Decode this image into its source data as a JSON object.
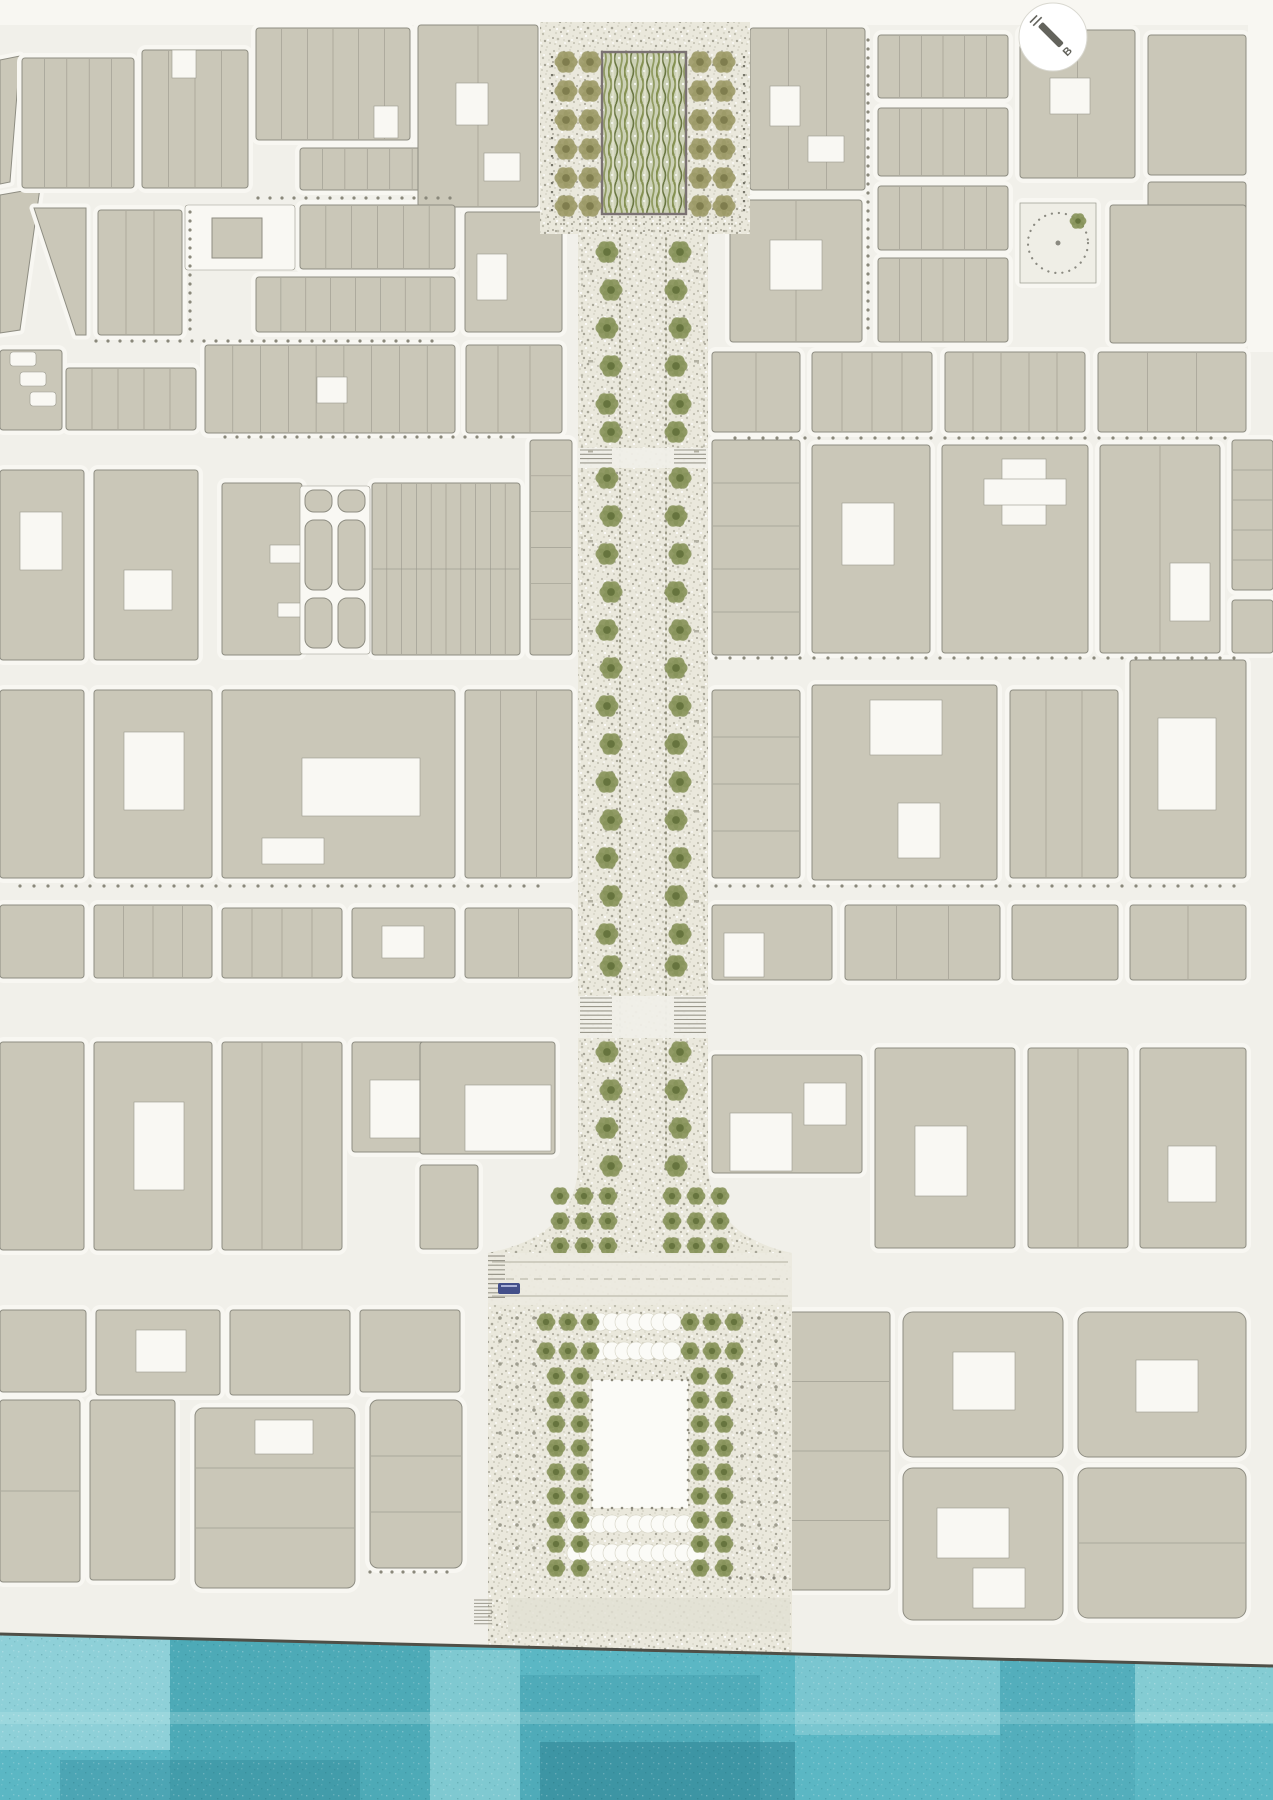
{
  "meta": {
    "width": 1273,
    "height": 1800,
    "label": "urban-masterplan-site-plan"
  },
  "north_arrow": {
    "letter": "B"
  },
  "colors": {
    "street": "#f1f0ea",
    "sidewalk": "#f8f7f2",
    "building": "#cac7b8",
    "outline": "#8e8d82",
    "divline": "#9a988c",
    "plot": "#f9f8f3",
    "plotLine": "#99988d",
    "stipBase": "#eae8dc",
    "stipA": "#d8d6c8",
    "stipB": "#c0beaf",
    "stipC": "#a6a496",
    "oliveL": "#9aa668",
    "oliveM": "#87935a",
    "oliveD": "#66743e",
    "khakiL": "#b3af7e",
    "khakiM": "#9c9a67",
    "khakiD": "#7f7d4e",
    "gardenBase": "#ccd1b6",
    "gardenA": "#7d8b47",
    "gardenB": "#5f6e35",
    "gardenC": "#e4e6d2",
    "gardenBorder": "#7b7273",
    "dotline": "#85836f",
    "bollard": "#77766a",
    "gridDot": "#8b897b",
    "crossBand": "#f0efe8",
    "ladder": "#9a988c",
    "roadFill": "#eceadf",
    "roadMark": "#b2b0a1",
    "bus": "#44508a",
    "mall": "#fbfbf7",
    "scallop": "#fbfbf7",
    "scallopLine": "#d6d4c5",
    "quayStrip": "#e2e0d4",
    "waterBase": "#5bb7c4",
    "waterLight": "#c2eaec",
    "waterDark": "#3a95a5",
    "waterDeep": "#2b7f90",
    "waterLine": "#4f4f47",
    "needle": "#63635c",
    "circleRim": "#d9d8d0"
  },
  "bands": [
    [
      0,
      0,
      1273,
      25
    ],
    [
      1248,
      0,
      27,
      352
    ]
  ],
  "blocks": [
    {
      "x": 22,
      "y": 58,
      "w": 112,
      "h": 130,
      "v": 5
    },
    {
      "x": 142,
      "y": 50,
      "w": 106,
      "h": 138,
      "v": 4,
      "wh": [
        [
          30,
          0,
          24,
          28
        ]
      ]
    },
    {
      "x": 256,
      "y": 28,
      "w": 154,
      "h": 112,
      "v": 6,
      "wh": [
        [
          118,
          78,
          24,
          32
        ]
      ]
    },
    {
      "x": 300,
      "y": 148,
      "w": 157,
      "h": 42,
      "v": 7
    },
    {
      "x": 418,
      "y": 25,
      "w": 120,
      "h": 182,
      "v": 2,
      "wh": [
        [
          38,
          58,
          32,
          42
        ],
        [
          66,
          128,
          36,
          28
        ]
      ]
    },
    {
      "x": 98,
      "y": 210,
      "w": 84,
      "h": 125,
      "v": 3
    },
    {
      "x": 300,
      "y": 205,
      "w": 155,
      "h": 64,
      "v": 6
    },
    {
      "x": 256,
      "y": 277,
      "w": 199,
      "h": 55,
      "v": 8
    },
    {
      "x": 465,
      "y": 212,
      "w": 97,
      "h": 120,
      "wh": [
        [
          12,
          42,
          30,
          46
        ]
      ]
    },
    {
      "x": 0,
      "y": 350,
      "w": 62,
      "h": 80
    },
    {
      "x": 66,
      "y": 368,
      "w": 130,
      "h": 62,
      "v": 5
    },
    {
      "x": 205,
      "y": 345,
      "w": 250,
      "h": 88,
      "v": 9,
      "wh": [
        [
          112,
          32,
          30,
          26
        ]
      ]
    },
    {
      "x": 466,
      "y": 345,
      "w": 96,
      "h": 88,
      "v": 3
    },
    {
      "x": 0,
      "y": 470,
      "w": 84,
      "h": 190,
      "wh": [
        [
          20,
          42,
          42,
          58
        ]
      ]
    },
    {
      "x": 94,
      "y": 470,
      "w": 104,
      "h": 190,
      "wh": [
        [
          30,
          100,
          48,
          40
        ]
      ]
    },
    {
      "x": 222,
      "y": 483,
      "w": 80,
      "h": 172,
      "wh": [
        [
          48,
          62,
          32,
          18
        ],
        [
          56,
          120,
          24,
          14
        ]
      ]
    },
    {
      "x": 372,
      "y": 483,
      "w": 148,
      "h": 172,
      "v": 10,
      "hd": 2
    },
    {
      "x": 530,
      "y": 440,
      "w": 42,
      "h": 215,
      "hd": 6
    },
    {
      "x": 0,
      "y": 690,
      "w": 84,
      "h": 188
    },
    {
      "x": 94,
      "y": 690,
      "w": 118,
      "h": 188,
      "wh": [
        [
          30,
          42,
          60,
          78
        ]
      ]
    },
    {
      "x": 222,
      "y": 690,
      "w": 233,
      "h": 188,
      "wh": [
        [
          80,
          68,
          118,
          58
        ],
        [
          40,
          148,
          62,
          26
        ]
      ]
    },
    {
      "x": 465,
      "y": 690,
      "w": 107,
      "h": 188,
      "v": 3
    },
    {
      "x": 0,
      "y": 905,
      "w": 84,
      "h": 73
    },
    {
      "x": 94,
      "y": 905,
      "w": 118,
      "h": 73,
      "v": 4
    },
    {
      "x": 222,
      "y": 908,
      "w": 120,
      "h": 70,
      "v": 4
    },
    {
      "x": 352,
      "y": 908,
      "w": 103,
      "h": 70,
      "wh": [
        [
          30,
          18,
          42,
          32
        ]
      ]
    },
    {
      "x": 465,
      "y": 908,
      "w": 107,
      "h": 70,
      "v": 2
    },
    {
      "x": 0,
      "y": 1042,
      "w": 84,
      "h": 208
    },
    {
      "x": 94,
      "y": 1042,
      "w": 118,
      "h": 208,
      "wh": [
        [
          40,
          60,
          50,
          88
        ]
      ]
    },
    {
      "x": 222,
      "y": 1042,
      "w": 120,
      "h": 208,
      "v": 3
    },
    {
      "x": 352,
      "y": 1042,
      "w": 100,
      "h": 110,
      "wh": [
        [
          18,
          38,
          70,
          58
        ]
      ]
    },
    {
      "x": 420,
      "y": 1042,
      "w": 135,
      "h": 112,
      "wh": [
        [
          45,
          43,
          86,
          66
        ]
      ]
    },
    {
      "x": 420,
      "y": 1165,
      "w": 58,
      "h": 84
    },
    {
      "x": 0,
      "y": 1310,
      "w": 86,
      "h": 82
    },
    {
      "x": 96,
      "y": 1310,
      "w": 124,
      "h": 85,
      "wh": [
        [
          40,
          20,
          50,
          42
        ]
      ]
    },
    {
      "x": 230,
      "y": 1310,
      "w": 120,
      "h": 85
    },
    {
      "x": 360,
      "y": 1310,
      "w": 100,
      "h": 82
    },
    {
      "x": 0,
      "y": 1400,
      "w": 80,
      "h": 182,
      "hd": 2
    },
    {
      "x": 90,
      "y": 1400,
      "w": 85,
      "h": 180
    },
    {
      "x": 195,
      "y": 1408,
      "w": 160,
      "h": 180,
      "hd": 3,
      "r": 8,
      "wh": [
        [
          60,
          12,
          58,
          34
        ]
      ]
    },
    {
      "x": 370,
      "y": 1400,
      "w": 92,
      "h": 168,
      "hd": 3,
      "r": 8
    },
    {
      "x": 750,
      "y": 28,
      "w": 115,
      "h": 162,
      "v": 3,
      "wh": [
        [
          20,
          58,
          30,
          40
        ],
        [
          58,
          108,
          36,
          26
        ]
      ]
    },
    {
      "x": 878,
      "y": 35,
      "w": 130,
      "h": 63,
      "v": 6
    },
    {
      "x": 878,
      "y": 108,
      "w": 130,
      "h": 68,
      "v": 6
    },
    {
      "x": 1020,
      "y": 30,
      "w": 115,
      "h": 148,
      "v": 2,
      "wh": [
        [
          30,
          48,
          40,
          36
        ]
      ]
    },
    {
      "x": 1148,
      "y": 35,
      "w": 98,
      "h": 140
    },
    {
      "x": 1148,
      "y": 182,
      "w": 98,
      "h": 158
    },
    {
      "x": 730,
      "y": 200,
      "w": 132,
      "h": 142,
      "v": 2,
      "wh": [
        [
          40,
          40,
          52,
          50
        ]
      ]
    },
    {
      "x": 878,
      "y": 186,
      "w": 130,
      "h": 64,
      "v": 6
    },
    {
      "x": 878,
      "y": 258,
      "w": 130,
      "h": 84,
      "v": 6
    },
    {
      "x": 1110,
      "y": 205,
      "w": 136,
      "h": 138
    },
    {
      "x": 712,
      "y": 352,
      "w": 88,
      "h": 80,
      "v": 2
    },
    {
      "x": 812,
      "y": 352,
      "w": 120,
      "h": 80,
      "v": 4
    },
    {
      "x": 945,
      "y": 352,
      "w": 140,
      "h": 80,
      "v": 5
    },
    {
      "x": 1098,
      "y": 352,
      "w": 148,
      "h": 80,
      "v": 3
    },
    {
      "x": 712,
      "y": 440,
      "w": 88,
      "h": 215,
      "hd": 5
    },
    {
      "x": 812,
      "y": 445,
      "w": 118,
      "h": 208,
      "wh": [
        [
          30,
          58,
          52,
          62
        ]
      ]
    },
    {
      "x": 942,
      "y": 445,
      "w": 146,
      "h": 208,
      "wh": [
        [
          60,
          14,
          44,
          66
        ],
        [
          42,
          34,
          82,
          26
        ]
      ]
    },
    {
      "x": 1100,
      "y": 445,
      "w": 120,
      "h": 208,
      "v": 2,
      "wh": [
        [
          70,
          118,
          40,
          58
        ]
      ]
    },
    {
      "x": 1232,
      "y": 440,
      "w": 41,
      "h": 150,
      "hd": 5
    },
    {
      "x": 1232,
      "y": 600,
      "w": 41,
      "h": 53
    },
    {
      "x": 712,
      "y": 690,
      "w": 88,
      "h": 188,
      "hd": 4
    },
    {
      "x": 812,
      "y": 685,
      "w": 185,
      "h": 195,
      "wh": [
        [
          58,
          15,
          72,
          55
        ],
        [
          86,
          118,
          42,
          55
        ]
      ]
    },
    {
      "x": 1010,
      "y": 690,
      "w": 108,
      "h": 188,
      "v": 3
    },
    {
      "x": 1130,
      "y": 660,
      "w": 116,
      "h": 218,
      "wh": [
        [
          28,
          58,
          58,
          92
        ]
      ]
    },
    {
      "x": 712,
      "y": 905,
      "w": 120,
      "h": 75,
      "wh": [
        [
          12,
          28,
          40,
          44
        ]
      ]
    },
    {
      "x": 845,
      "y": 905,
      "w": 155,
      "h": 75,
      "v": 3
    },
    {
      "x": 1012,
      "y": 905,
      "w": 106,
      "h": 75
    },
    {
      "x": 1130,
      "y": 905,
      "w": 116,
      "h": 75,
      "v": 2
    },
    {
      "x": 712,
      "y": 1055,
      "w": 150,
      "h": 118,
      "wh": [
        [
          18,
          58,
          62,
          58
        ],
        [
          92,
          28,
          42,
          42
        ]
      ]
    },
    {
      "x": 875,
      "y": 1048,
      "w": 140,
      "h": 200,
      "wh": [
        [
          40,
          78,
          52,
          70
        ]
      ]
    },
    {
      "x": 1028,
      "y": 1048,
      "w": 100,
      "h": 200,
      "v": 2
    },
    {
      "x": 1140,
      "y": 1048,
      "w": 106,
      "h": 200,
      "wh": [
        [
          28,
          98,
          48,
          56
        ]
      ]
    },
    {
      "x": 790,
      "y": 1312,
      "w": 100,
      "h": 278,
      "hd": 4
    },
    {
      "x": 903,
      "y": 1312,
      "w": 160,
      "h": 145,
      "r": 10,
      "wh": [
        [
          50,
          40,
          62,
          58
        ]
      ]
    },
    {
      "x": 903,
      "y": 1468,
      "w": 160,
      "h": 152,
      "r": 10,
      "wh": [
        [
          34,
          40,
          72,
          50
        ],
        [
          70,
          100,
          52,
          40
        ]
      ]
    },
    {
      "x": 1078,
      "y": 1312,
      "w": 168,
      "h": 145,
      "r": 10,
      "wh": [
        [
          58,
          48,
          62,
          52
        ]
      ]
    },
    {
      "x": 1078,
      "y": 1468,
      "w": 168,
      "h": 150,
      "r": 10,
      "hd": 2
    }
  ],
  "polyBlocks": [
    {
      "pts": "0,195 40,188 20,330 0,333"
    },
    {
      "pts": "34,208 86,208 86,335 76,335"
    },
    {
      "pts": "0,60 20,56 10,182 0,184"
    }
  ],
  "plots": [
    [
      185,
      205,
      110,
      65
    ],
    [
      300,
      486,
      70,
      168
    ],
    [
      10,
      352,
      26,
      14
    ],
    [
      20,
      372,
      26,
      14
    ],
    [
      30,
      392,
      26,
      14
    ]
  ],
  "innerRects": [
    [
      212,
      218,
      50,
      40
    ]
  ],
  "bars": {
    "cols": [
      305,
      338
    ],
    "w": 27,
    "rows": [
      [
        490,
        22
      ],
      [
        520,
        70
      ],
      [
        598,
        50
      ]
    ]
  },
  "circleGarden": {
    "x": 1020,
    "y": 203,
    "w": 76,
    "h": 80
  },
  "axis": {
    "topPlaza": {
      "x": 540,
      "y": 22,
      "w": 210,
      "h": 212
    },
    "garden": {
      "x": 602,
      "y": 52,
      "w": 84,
      "h": 162
    },
    "gardenTreeCols": {
      "left": [
        566,
        590
      ],
      "right": [
        700,
        724
      ],
      "rows": [
        62,
        91,
        120,
        149,
        178,
        206
      ]
    },
    "bollardCols": [
      552,
      744
    ],
    "bollardRows": {
      "y0": 56,
      "n": 18,
      "dy": 9
    },
    "dotsBand": {
      "x": 548,
      "w": 196,
      "ys": [
        217,
        224,
        231
      ],
      "dx": 8
    },
    "boulevard": {
      "x": 578,
      "y": 232,
      "w": 130,
      "bottom": 1172
    },
    "dotLanes": [
      620,
      666
    ],
    "edgeLanes": [
      582,
      704
    ],
    "treeCols": [
      609,
      678
    ],
    "treeRows": [
      252,
      290,
      328,
      366,
      404,
      432,
      478,
      516,
      554,
      592,
      630,
      668,
      706,
      744,
      782,
      820,
      858,
      896,
      934,
      966,
      1052,
      1090,
      1128,
      1166
    ],
    "crossings": [
      {
        "y": 448,
        "h": 20
      },
      {
        "y": 996,
        "h": 42
      }
    ],
    "flare": {
      "topY": 1168,
      "plazaX": 488,
      "plazaW": 304
    },
    "flareTrees": {
      "leftCols": [
        560,
        584,
        608
      ],
      "rightCols": [
        672,
        696,
        720
      ],
      "rows": [
        1196,
        1221,
        1246
      ]
    },
    "plaza": {
      "dotGrid": {
        "cols": [
          500,
          517,
          534,
          742,
          759,
          776
        ],
        "y0": 1318,
        "rows": 11,
        "dy": 23
      },
      "treeCols": [
        556,
        580,
        700,
        724
      ],
      "treeColRows": {
        "y0": 1376,
        "n": 9,
        "dy": 24
      },
      "hTreeRows": {
        "ys": [
          1322,
          1351
        ],
        "left": [
          546,
          568,
          590
        ],
        "right": [
          690,
          712,
          734
        ]
      },
      "scallops": [
        {
          "y": 1322,
          "x0": 600,
          "x1": 672
        },
        {
          "y": 1351,
          "x0": 600,
          "x1": 672
        },
        {
          "y": 1524,
          "x0": 576,
          "x1": 704
        },
        {
          "y": 1553,
          "x0": 576,
          "x1": 704
        }
      ],
      "mall": {
        "x": 592,
        "y": 1380,
        "w": 96,
        "h": 128
      }
    },
    "road": {
      "y": 1253,
      "h": 52,
      "x": 488,
      "w": 304,
      "busX": 498,
      "busY": 1283
    },
    "quay": {
      "strip": {
        "x": 508,
        "y": 1598,
        "w": 282,
        "h": 34
      },
      "ladder": {
        "x": 474,
        "y": 1600,
        "n": 8,
        "dy": 3.4,
        "w": 18
      }
    }
  },
  "streetDots": [
    {
      "t": "v",
      "x": 190,
      "y": 212,
      "n": 14,
      "d": 9
    },
    {
      "t": "v",
      "x": 868,
      "y": 40,
      "n": 33,
      "d": 9
    },
    {
      "t": "h",
      "x": 258,
      "y": 198,
      "n": 17,
      "d": 12
    },
    {
      "t": "h",
      "x": 96,
      "y": 341,
      "n": 29,
      "d": 12
    },
    {
      "t": "h",
      "x": 225,
      "y": 437,
      "n": 25,
      "d": 12
    },
    {
      "t": "h",
      "x": 735,
      "y": 438,
      "n": 36,
      "d": 14
    },
    {
      "t": "h",
      "x": 716,
      "y": 658,
      "n": 38,
      "d": 14
    },
    {
      "t": "h",
      "x": 20,
      "y": 886,
      "n": 38,
      "d": 14
    },
    {
      "t": "h",
      "x": 716,
      "y": 886,
      "n": 38,
      "d": 14
    },
    {
      "t": "h",
      "x": 370,
      "y": 1572,
      "n": 8,
      "d": 11
    },
    {
      "t": "h",
      "x": 730,
      "y": 1578,
      "n": 6,
      "d": 11
    }
  ],
  "benches": {
    "xs": [
      588,
      694
    ],
    "y0": 270,
    "n": 8,
    "dy": 90
  },
  "water": {
    "edge": {
      "x0": 0,
      "y0": 1634,
      "x1": 1273,
      "y1": 1666
    },
    "patches": [
      {
        "x": 0,
        "y": 1630,
        "w": 170,
        "h": 120,
        "c": "waterLight",
        "o": 0.5
      },
      {
        "x": 170,
        "y": 1632,
        "w": 260,
        "h": 168,
        "c": "waterDark",
        "o": 0.4
      },
      {
        "x": 430,
        "y": 1650,
        "w": 90,
        "h": 150,
        "c": "waterLight",
        "o": 0.35
      },
      {
        "x": 520,
        "y": 1675,
        "w": 240,
        "h": 125,
        "c": "waterDark",
        "o": 0.35
      },
      {
        "x": 795,
        "y": 1640,
        "w": 205,
        "h": 95,
        "c": "waterLight",
        "o": 0.3
      },
      {
        "x": 1000,
        "y": 1645,
        "w": 135,
        "h": 155,
        "c": "waterDark",
        "o": 0.25
      },
      {
        "x": 1135,
        "y": 1648,
        "w": 138,
        "h": 75,
        "c": "waterLight",
        "o": 0.4
      },
      {
        "x": 540,
        "y": 1742,
        "w": 255,
        "h": 58,
        "c": "waterDeep",
        "o": 0.5
      },
      {
        "x": 60,
        "y": 1760,
        "w": 300,
        "h": 40,
        "c": "waterDeep",
        "o": 0.3
      },
      {
        "x": 0,
        "y": 1712,
        "w": 1273,
        "h": 12,
        "c": "waterLight",
        "o": 0.25
      }
    ]
  }
}
